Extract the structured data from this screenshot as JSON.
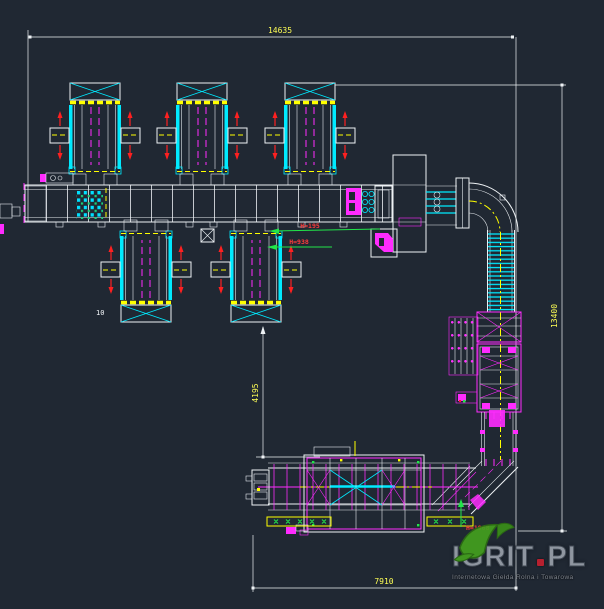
{
  "drawing": {
    "type": "cad-plant-layout",
    "dimensions": {
      "top_width": "14635",
      "right_height": "13400",
      "bottom_width": "7910",
      "left_vertical": "4195"
    },
    "labels": {
      "h195": "H=195",
      "h938": "H=938",
      "h1968": "H=1968",
      "count": "10"
    },
    "colors": {
      "background": "#202833",
      "line_white": "#eef2f5",
      "cyan": "#00eaff",
      "magenta": "#ff2bff",
      "yellow": "#ffff00",
      "green": "#22e54a",
      "red": "#ff2020",
      "dim_text": "#ffff55",
      "annotation_red": "#ff3b3b"
    }
  },
  "watermark": {
    "brand": "IGRIT",
    "tld": "PL",
    "subtitle": "Internetowa Giełda Rolna i Towarowa",
    "dot_color": "#c3202f",
    "leaf_color": "#43a01e"
  }
}
